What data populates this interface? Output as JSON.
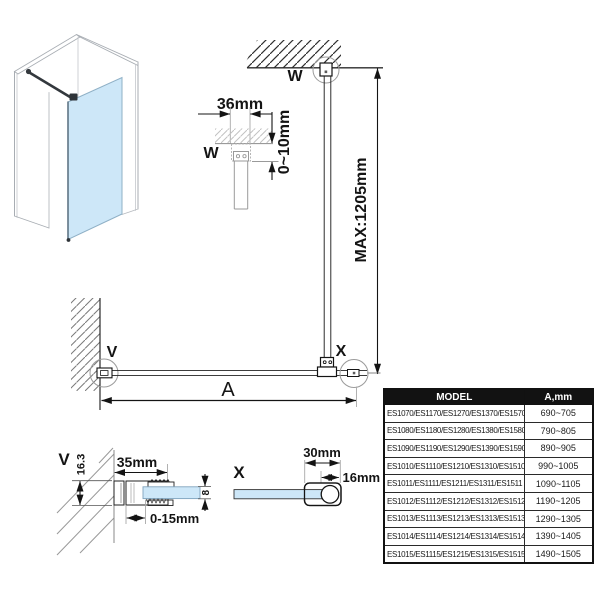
{
  "colors": {
    "glass_blue": "#cde7f8",
    "line_dark": "#141414",
    "table_header_bg": "#121212",
    "table_header_text": "#ffffff"
  },
  "detail_w": {
    "label": "W",
    "dim_width": "36mm",
    "dim_adjust": "0~10mm"
  },
  "elevation": {
    "label_w": "W",
    "dim_max": "MAX:1205mm"
  },
  "plan": {
    "label_v": "V",
    "label_x": "X",
    "dim_a": "A"
  },
  "detail_v": {
    "label": "V",
    "dim_height": "16.3",
    "dim_width": "35mm",
    "dim_adjust": "0-15mm",
    "dim_glass_thickness": "8"
  },
  "detail_x": {
    "label": "X",
    "dim_width": "30mm",
    "dim_bar": "16mm"
  },
  "table": {
    "headers": {
      "model": "MODEL",
      "a_mm": "A,mm"
    },
    "rows": [
      {
        "model": "ES1070/ES1170/ES1270/ES1370/ES1570",
        "a_mm": "690~705"
      },
      {
        "model": "ES1080/ES1180/ES1280/ES1380/ES1580",
        "a_mm": "790~805"
      },
      {
        "model": "ES1090/ES1190/ES1290/ES1390/ES1590",
        "a_mm": "890~905"
      },
      {
        "model": "ES1010/ES1110/ES1210/ES1310/ES1510",
        "a_mm": "990~1005"
      },
      {
        "model": "ES1011/ES1111/ES1211/ES1311/ES1511",
        "a_mm": "1090~1105"
      },
      {
        "model": "ES1012/ES1112/ES1212/ES1312/ES1512",
        "a_mm": "1190~1205"
      },
      {
        "model": "ES1013/ES1113/ES1213/ES1313/ES1513",
        "a_mm": "1290~1305"
      },
      {
        "model": "ES1014/ES1114/ES1214/ES1314/ES1514",
        "a_mm": "1390~1405"
      },
      {
        "model": "ES1015/ES1115/ES1215/ES1315/ES1515",
        "a_mm": "1490~1505"
      }
    ]
  }
}
